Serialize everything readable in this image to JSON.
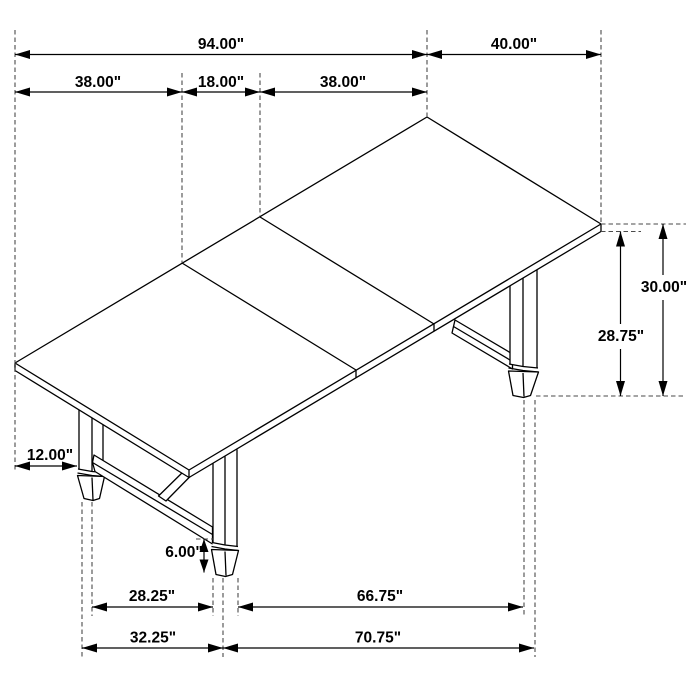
{
  "diagram": {
    "kind": "isometric furniture dimension drawing",
    "units": "inches",
    "colors": {
      "background": "#ffffff",
      "line": "#000000",
      "extension_line": "#4a4a4a"
    },
    "dims": {
      "overall_length": "94.00\"",
      "width": "40.00\"",
      "section_left": "38.00\"",
      "leaf": "18.00\"",
      "section_right": "38.00\"",
      "height": "30.00\"",
      "height_to_underside": "28.75\"",
      "leg_inset": "12.00\"",
      "foot_height": "6.00\"",
      "feet_span_inner": "28.25\"",
      "span_front_inner": "66.75\"",
      "feet_span_outer": "32.25\"",
      "span_front_outer": "70.75\""
    }
  }
}
